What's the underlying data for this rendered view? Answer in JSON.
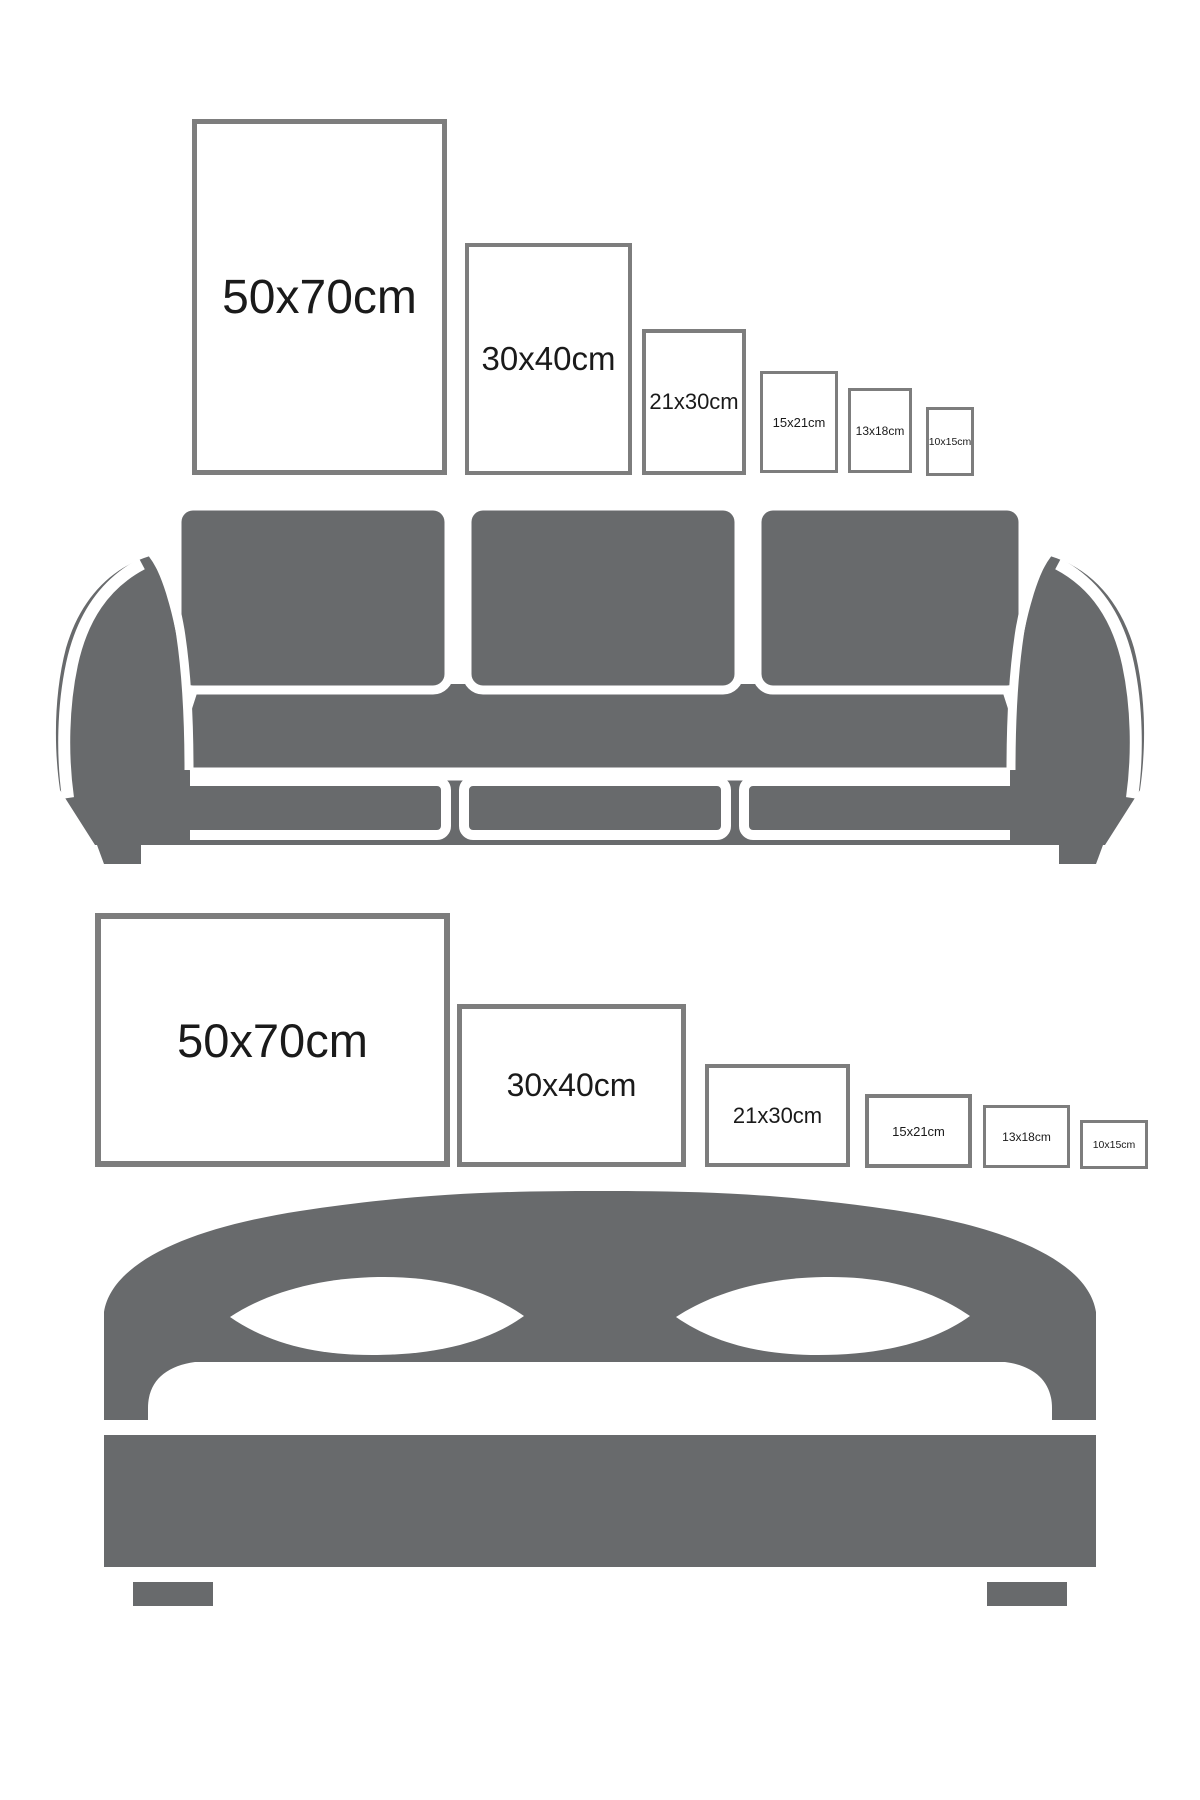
{
  "colors": {
    "furniture": "#686a6c",
    "frame_border": "#7d7d7d",
    "text": "#1a1a1a",
    "background": "#ffffff"
  },
  "sections": [
    {
      "name": "sofa-size-guide",
      "furniture": "sofa",
      "orientation": "portrait",
      "frames": [
        {
          "label": "50x70cm"
        },
        {
          "label": "30x40cm"
        },
        {
          "label": "21x30cm"
        },
        {
          "label": "15x21cm"
        },
        {
          "label": "13x18cm"
        },
        {
          "label": "10x15cm"
        }
      ]
    },
    {
      "name": "bed-size-guide",
      "furniture": "bed",
      "orientation": "landscape",
      "frames": [
        {
          "label": "50x70cm"
        },
        {
          "label": "30x40cm"
        },
        {
          "label": "21x30cm"
        },
        {
          "label": "15x21cm"
        },
        {
          "label": "13x18cm"
        },
        {
          "label": "10x15cm"
        }
      ]
    }
  ]
}
